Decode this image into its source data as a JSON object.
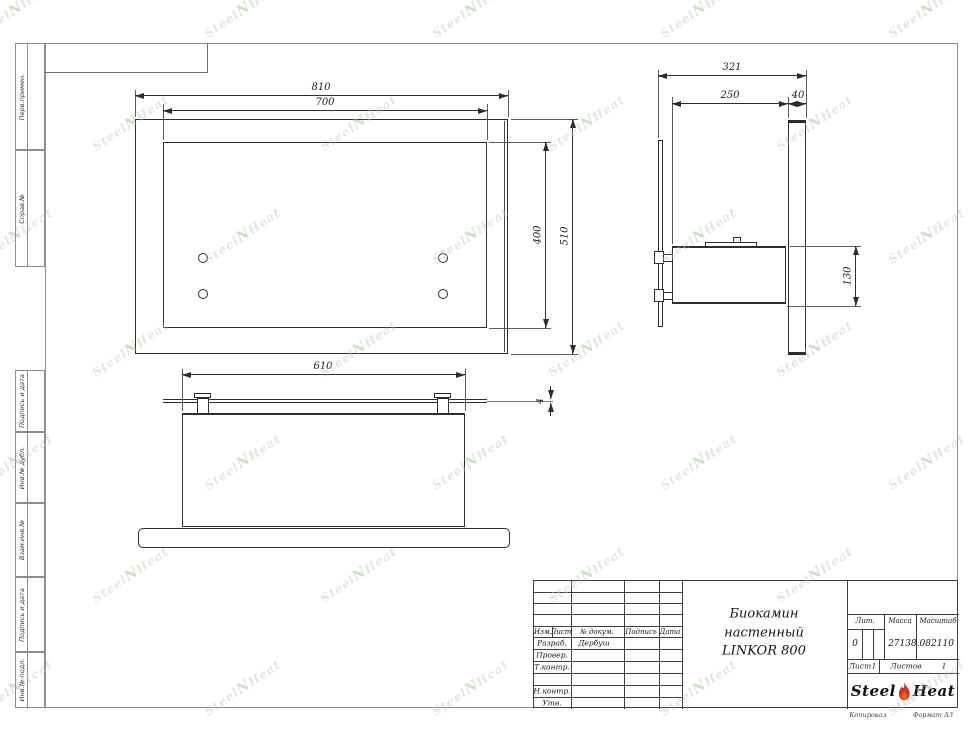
{
  "brand": {
    "left": "Steel",
    "right": "Heat",
    "watermark_mid": "N"
  },
  "frame": {
    "margin_labels_top": [
      "Перв.примен.",
      "Справ.№"
    ],
    "margin_labels_bottom": [
      "Подпись и дата",
      "Инв.№ дубл.",
      "Взам.инв.№",
      "Подпись и дата",
      "Инв.№ подл."
    ]
  },
  "views": {
    "front": {
      "dims": {
        "outer_width": "810",
        "inner_width": "700",
        "inner_height": "400",
        "outer_height": "510"
      }
    },
    "side": {
      "dims": {
        "total_depth": "321",
        "body_depth": "250",
        "panel_thickness": "40",
        "box_height": "130"
      }
    },
    "bottom": {
      "dims": {
        "box_width": "610",
        "glass_thickness": "4"
      }
    }
  },
  "title_block": {
    "header_cols": [
      "Изм.",
      "Лист",
      "№ докум.",
      "Подпись",
      "Дата"
    ],
    "sign_rows": [
      {
        "label": "Разраб.",
        "name": "Дербуш"
      },
      {
        "label": "Провер.",
        "name": ""
      },
      {
        "label": "Т.контр.",
        "name": ""
      },
      {
        "label": "",
        "name": ""
      },
      {
        "label": "Н.контр.",
        "name": ""
      },
      {
        "label": "Утв.",
        "name": ""
      }
    ],
    "title_lines": [
      "Биокамин",
      "настенный",
      "LINKOR 800"
    ],
    "lit_label": "Лит.",
    "lit_value": "0",
    "mass_label": "Масса",
    "scale_label": "Масштаб",
    "mass_scale_value": "27138.082110",
    "sheet_label": "Лист",
    "sheet_value": "1",
    "sheets_label": "Листов",
    "sheets_value": "1"
  },
  "footer": {
    "copied": "Копировал",
    "format": "Формат А3"
  },
  "colors": {
    "line": "#2d2d2d",
    "frame": "#8d8d8d",
    "flame_red": "#e02b20",
    "flame_orange": "#ff9d00",
    "watermark_gray": "#c6c6c6",
    "watermark_green": "#8fbf80"
  }
}
